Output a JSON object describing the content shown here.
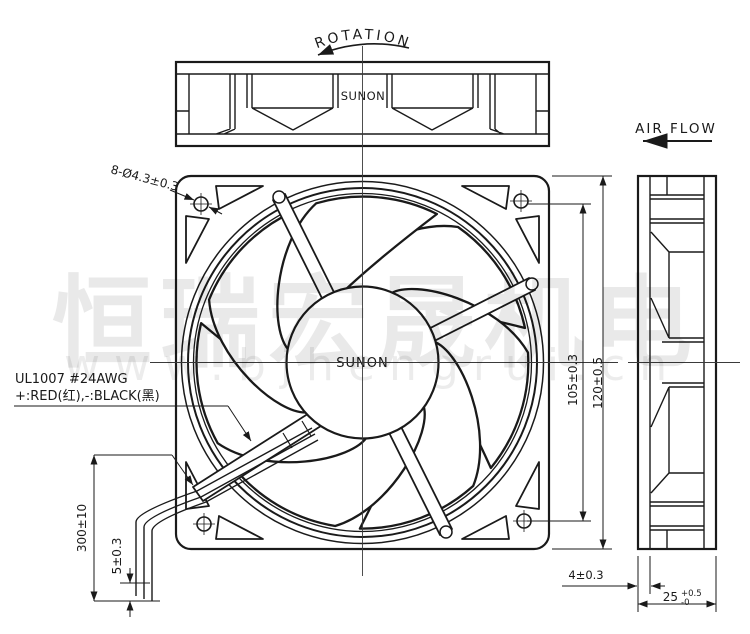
{
  "labels": {
    "rotation": "ROTATION",
    "airflow": "AIR FLOW",
    "hole_callout": "8-Ø4.3±0.3",
    "wire_spec_line1": "UL1007  #24AWG",
    "wire_spec_line2": "+:RED(红),-:BLACK(黑)"
  },
  "views": {
    "top": {
      "brand": "SUNON"
    },
    "front": {
      "hub_brand": "SUNON"
    }
  },
  "dimensions": {
    "hole_pitch": "105±0.3",
    "frame_size": "120±0.5",
    "lead_length": "300±10",
    "lead_strip": "5±0.3",
    "flange": "4±0.3",
    "depth": "25",
    "depth_tol_upper": "+0.5",
    "depth_tol_lower": "-0"
  },
  "watermark": {
    "text_cn": "恒瑞宏晟机电",
    "text_url": "www.bjhengrui.cn"
  },
  "colors": {
    "line": "#1a1a1a",
    "centerline": "#3a3a3a",
    "watermark": "rgba(0,0,0,0.08)",
    "background": "#ffffff"
  }
}
